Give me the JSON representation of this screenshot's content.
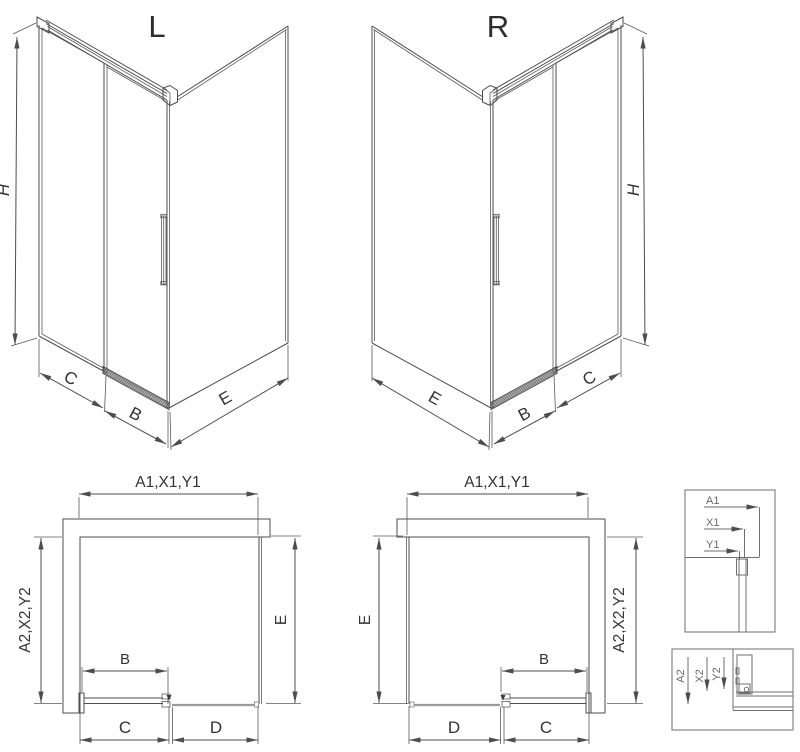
{
  "iso_left": {
    "title": "L",
    "dim_height": "H",
    "dim_wall": "C",
    "dim_door": "B",
    "dim_side": "E"
  },
  "iso_right": {
    "title": "R",
    "dim_height": "H",
    "dim_wall": "C",
    "dim_door": "B",
    "dim_side": "E"
  },
  "plan_left": {
    "dim_top": "A1,X1,Y1",
    "dim_left": "A2,X2,Y2",
    "dim_right": "E",
    "dim_door": "B",
    "dim_bottom_left": "C",
    "dim_bottom_right": "D"
  },
  "plan_right": {
    "dim_top": "A1,X1,Y1",
    "dim_left": "E",
    "dim_right": "A2,X2,Y2",
    "dim_door": "B",
    "dim_bottom_left": "D",
    "dim_bottom_right": "C"
  },
  "detail_top": {
    "dim_1": "A1",
    "dim_2": "X1",
    "dim_3": "Y1"
  },
  "detail_bottom": {
    "dim_1": "A2",
    "dim_2": "X2",
    "dim_3": "Y2"
  },
  "colors": {
    "line": "#4d4d4d",
    "gray_line": "#9b9b9b",
    "hatch": "#777777",
    "text": "#333333"
  }
}
